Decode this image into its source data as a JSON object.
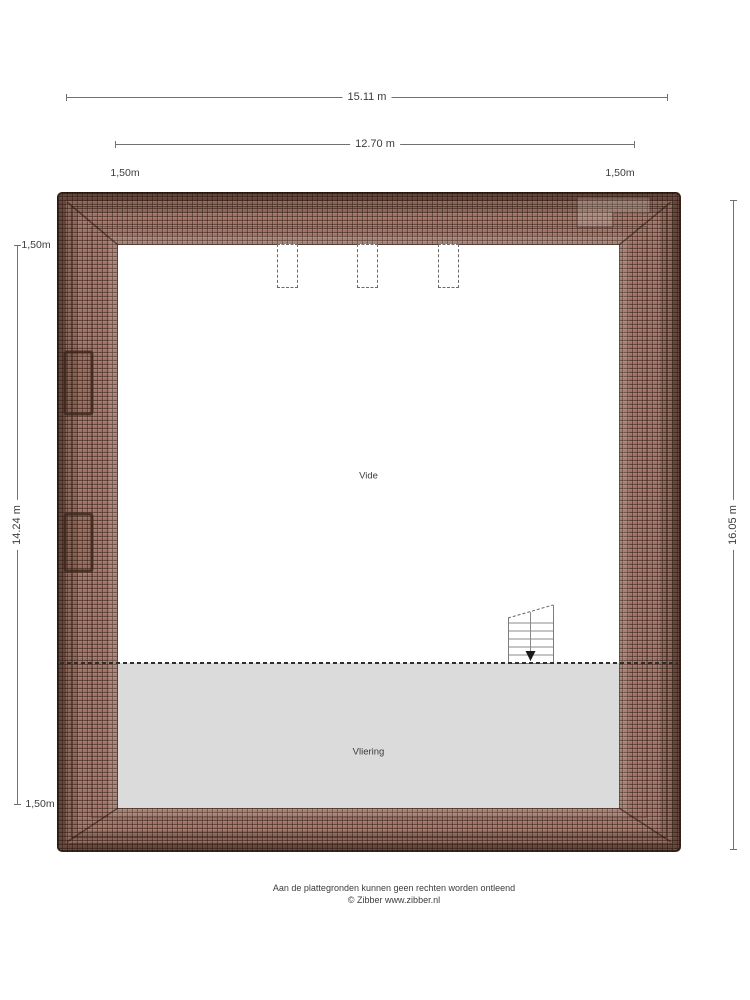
{
  "plan": {
    "floor_type": "roof-storey",
    "rooms": {
      "vide": "Vide",
      "vliering": "Vliering"
    },
    "features": {
      "skylight_count": 3,
      "roof_window_count": 2,
      "stairs": "down"
    }
  },
  "dimensions": {
    "top_outer_width": "15.11 m",
    "top_inner_width": "12.70 m",
    "top_left_eave": "1,50m",
    "top_right_eave": "1,50m",
    "left_top_eave": "1,50m",
    "left_inner_height": "14.24 m",
    "left_bottom_eave": "1,50m",
    "right_outer_height": "16.05 m"
  },
  "footer": {
    "line1": "Aan de plattegronden kunnen geen rechten worden ontleend",
    "line2": "© Zibber www.zibber.nl"
  },
  "colors": {
    "roof_base": "#9d7265",
    "roof_edge": "#2a1a12",
    "vliering_gray": "#dbdbdb",
    "dim_line": "#707070",
    "text": "#3c3c3c",
    "page_bg": "#ffffff"
  }
}
